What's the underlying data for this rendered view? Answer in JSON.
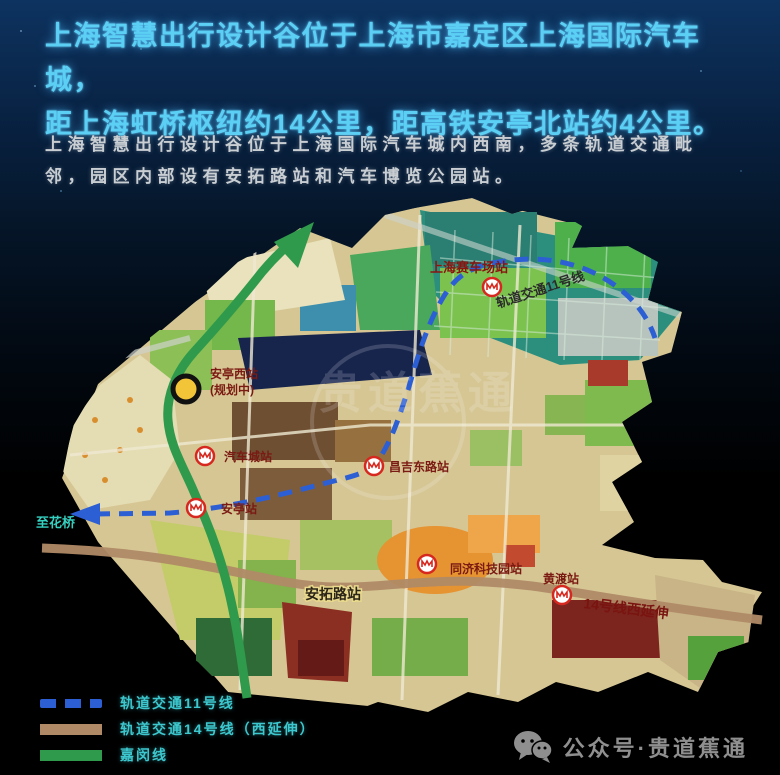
{
  "title": {
    "line1": "上海智慧出行设计谷位于上海市嘉定区上海国际汽车城，",
    "line2": "距上海虹桥枢纽约14公里，距高铁安亭北站约4公里。"
  },
  "intro": {
    "text": "上海智慧出行设计谷位于上海国际汽车城内西南，多条轨道交通毗邻，园区内部设有安拓路站和汽车博览公园站。"
  },
  "map": {
    "labels": {
      "saichechang_station": "上海赛车场站",
      "line11_on_map": "轨道交通11号线",
      "qichecheng_station": "汽车城站",
      "changjidonglu_station": "昌吉东路站",
      "anting_station": "安亭站",
      "tongji_station": "同济科技园站",
      "huangdu_station": "黄渡站",
      "line14_on_map": "14号线西延伸",
      "antuolu_station": "安拓路站",
      "antingxi_line1": "安亭西站",
      "antingxi_line2": "(规划中)",
      "to_huaqiao": "至花桥"
    },
    "watermark": "贵道蕉通"
  },
  "legend": {
    "items": [
      {
        "label": "轨道交通11号线",
        "style": "dashed",
        "color": "#2d5fd4"
      },
      {
        "label": "轨道交通14号线（西延伸）",
        "style": "solid",
        "color": "#b08a66"
      },
      {
        "label": "嘉闵线",
        "style": "solid",
        "color": "#2f9a4c"
      }
    ]
  },
  "footer": {
    "wechat_label": "公众号·贵道蕉通"
  },
  "colors": {
    "title_cyan": "#5bd0f4",
    "legend_cyan": "#3cc8ce",
    "line11_blue": "#2d5fd4",
    "line14_brown": "#b08a66",
    "jiamin_green": "#2f9a4c",
    "marker_yellow": "#f2c437",
    "station_label_red": "#7a1a12"
  }
}
